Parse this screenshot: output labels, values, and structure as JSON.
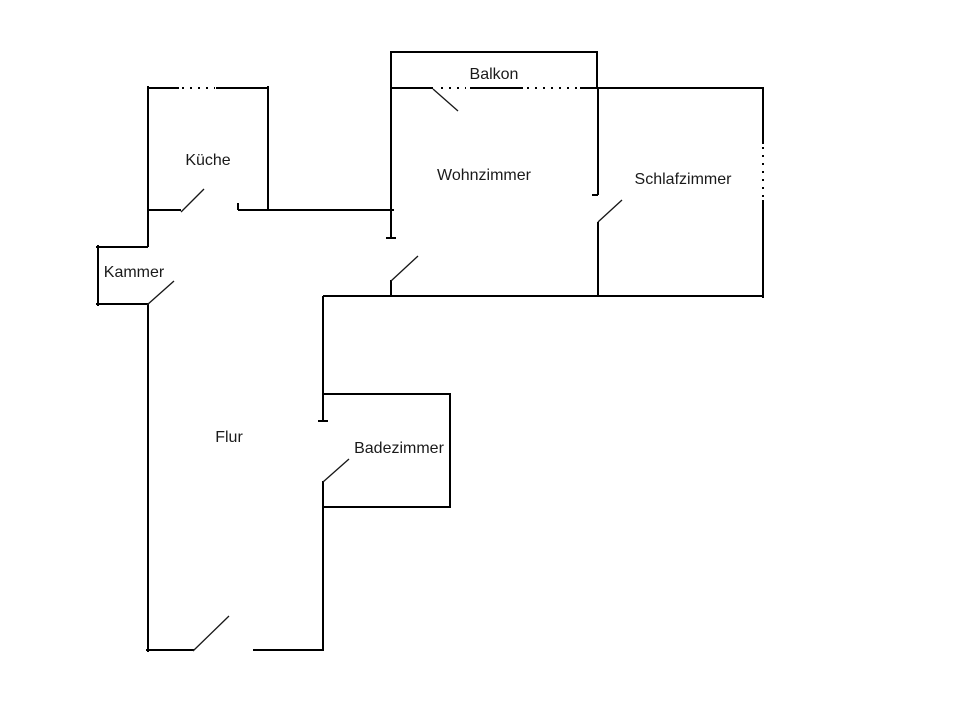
{
  "plan": {
    "canvas": {
      "width": 960,
      "height": 722,
      "background": "#ffffff"
    },
    "colors": {
      "wall": "#000000",
      "door": "#161616",
      "text": "#1a1a1a"
    },
    "rooms": [
      {
        "id": "balkon",
        "label": "Balkon",
        "x": 494,
        "y": 79
      },
      {
        "id": "kueche",
        "label": "Küche",
        "x": 208,
        "y": 165
      },
      {
        "id": "wohnzimmer",
        "label": "Wohnzimmer",
        "x": 484,
        "y": 180
      },
      {
        "id": "schlafzimmer",
        "label": "Schlafzimmer",
        "x": 683,
        "y": 184
      },
      {
        "id": "kammer",
        "label": "Kammer",
        "x": 134,
        "y": 277
      },
      {
        "id": "flur",
        "label": "Flur",
        "x": 229,
        "y": 442
      },
      {
        "id": "badezimmer",
        "label": "Badezimmer",
        "x": 399,
        "y": 453
      }
    ],
    "walls": [
      [
        148,
        86,
        148,
        247
      ],
      [
        147,
        88,
        179,
        88
      ],
      [
        216,
        88,
        269,
        88
      ],
      [
        268,
        86,
        268,
        211
      ],
      [
        147,
        210,
        181,
        210
      ],
      [
        238,
        210,
        394,
        210
      ],
      [
        238,
        203,
        238,
        210
      ],
      [
        96,
        247,
        148,
        247
      ],
      [
        98,
        245,
        98,
        306
      ],
      [
        96,
        304,
        148,
        304
      ],
      [
        148,
        304,
        148,
        652
      ],
      [
        146,
        650,
        194,
        650
      ],
      [
        253,
        650,
        324,
        650
      ],
      [
        323,
        650,
        323,
        481
      ],
      [
        323,
        421,
        323,
        296
      ],
      [
        318,
        421,
        328,
        421
      ],
      [
        323,
        394,
        451,
        394
      ],
      [
        450,
        394,
        450,
        508
      ],
      [
        323,
        507,
        451,
        507
      ],
      [
        391,
        52,
        391,
        238
      ],
      [
        386,
        238,
        396,
        238
      ],
      [
        391,
        280,
        391,
        297
      ],
      [
        390,
        52,
        598,
        52
      ],
      [
        597,
        52,
        597,
        88
      ],
      [
        390,
        88,
        433,
        88
      ],
      [
        470,
        88,
        523,
        88
      ],
      [
        580,
        88,
        764,
        88
      ],
      [
        598,
        88,
        598,
        195
      ],
      [
        592,
        195,
        598,
        195
      ],
      [
        598,
        222,
        598,
        296
      ],
      [
        763,
        88,
        763,
        144
      ],
      [
        763,
        200,
        763,
        298
      ],
      [
        323,
        296,
        764,
        296
      ]
    ],
    "windows": [
      [
        182,
        88,
        215,
        88
      ],
      [
        441,
        88,
        466,
        88
      ],
      [
        527,
        88,
        578,
        88
      ],
      [
        763,
        147,
        763,
        198
      ]
    ],
    "doors": [
      [
        181,
        212,
        204,
        189
      ],
      [
        433,
        89,
        458,
        111
      ],
      [
        391,
        281,
        418,
        256
      ],
      [
        598,
        222,
        622,
        200
      ],
      [
        147,
        305,
        174,
        281
      ],
      [
        323,
        482,
        349,
        459
      ],
      [
        193,
        651,
        229,
        616
      ]
    ]
  }
}
